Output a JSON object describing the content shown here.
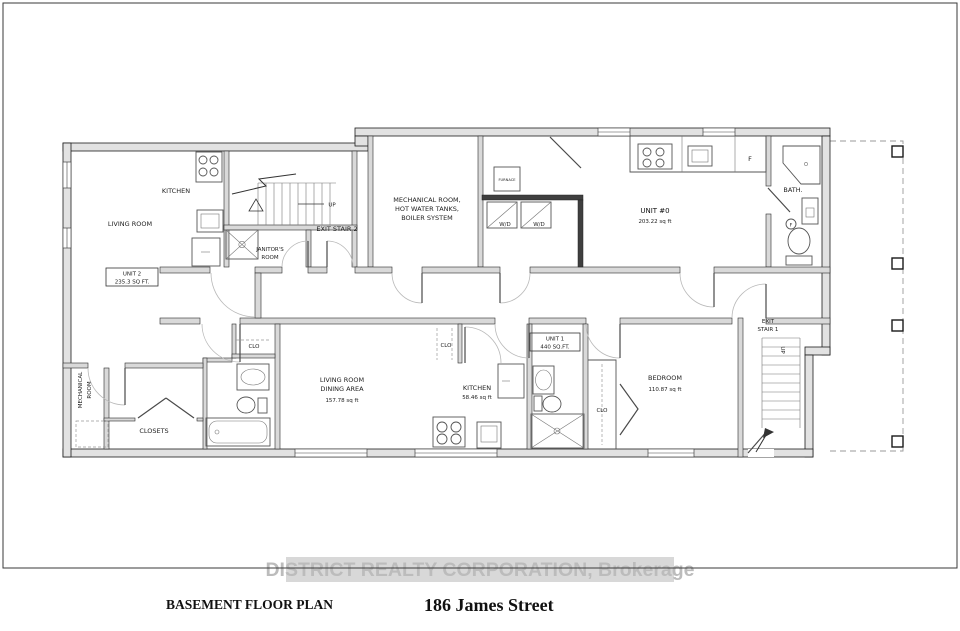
{
  "sheet": {
    "plan_title": "BASEMENT FLOOR PLAN",
    "address": "186 James Street",
    "watermark": "DISTRICT REALTY CORPORATION, Brokerage"
  },
  "labels": {
    "living_room": "LIVING ROOM",
    "kitchen_unit2": "KITCHEN",
    "unit2_name": "UNIT 2",
    "unit2_area": "235.3 SQ FT.",
    "exit_stair2": "EXIT STAIR 2",
    "up2": "UP",
    "janitors_line1": "JANITOR'S",
    "janitors_line2": "ROOM",
    "mech_line1": "MECHANICAL ROOM,",
    "mech_line2": "HOT WATER TANKS,",
    "mech_line3": "BOILER SYSTEM",
    "furnace": "FURNACE",
    "wd_left": "W/D",
    "wd_right": "W/D",
    "unit0_name": "UNIT #0",
    "unit0_area": "203.22 sq ft",
    "fridge_unit0": "F",
    "bath": "BATH.",
    "floor_drain": "F",
    "mech_lower_line1": "MECHANICAL",
    "mech_lower_line2": "ROOM",
    "closets": "CLOSETS",
    "clo_left": "CLO",
    "clo_mid": "CLO",
    "clo_bedroom": "CLO",
    "living_dining_line1": "LIVING ROOM",
    "living_dining_line2": "DINING AREA",
    "living_dining_area": "157.78 sq ft",
    "kitchen_unit1": "KITCHEN",
    "kitchen_unit1_area": "58.46 sq ft",
    "unit1_name": "UNIT 1",
    "unit1_area": "440 SQ.FT.",
    "bedroom_name": "BEDROOM",
    "bedroom_area": "110.87 sq ft",
    "exit_stair1_line1": "EXIT",
    "exit_stair1_line2": "STAIR 1",
    "up1": "UP"
  }
}
